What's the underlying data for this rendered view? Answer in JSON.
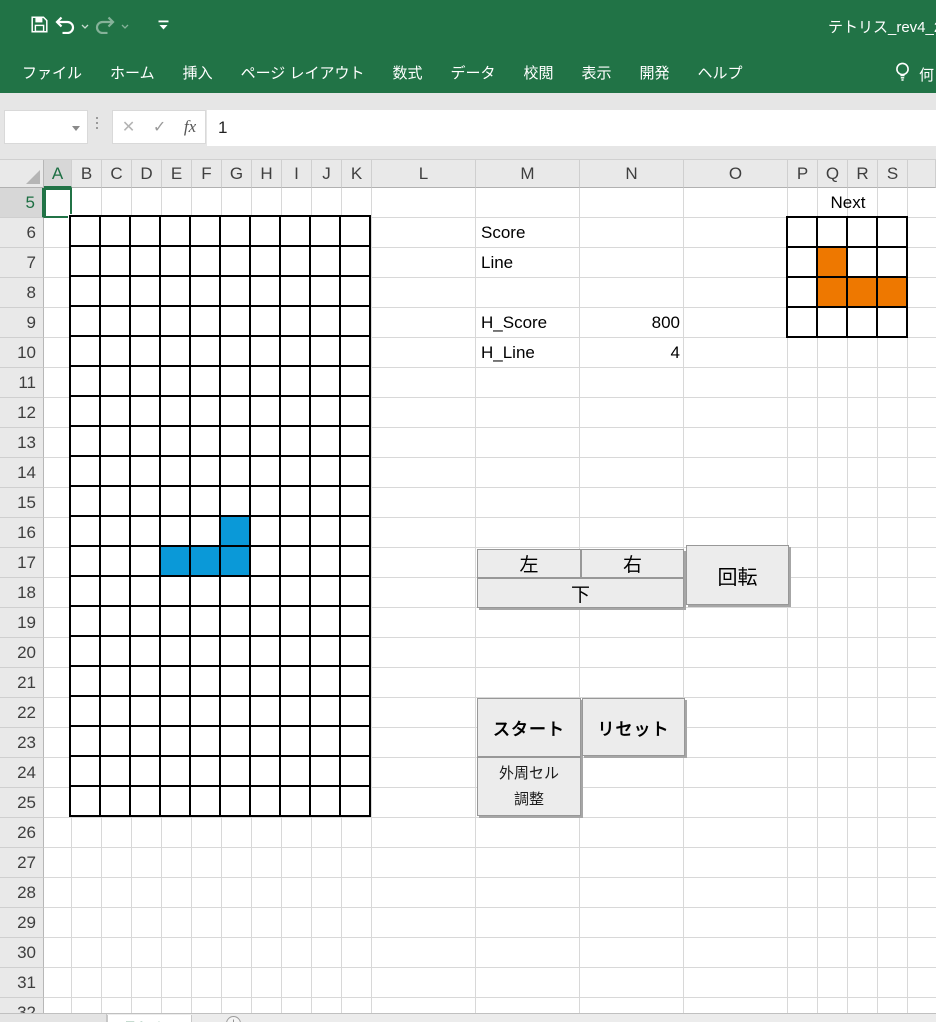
{
  "titlebar": {
    "title": "テトリス_rev4_2"
  },
  "ribbon": {
    "tabs": [
      "ファイル",
      "ホーム",
      "挿入",
      "ページ レイアウト",
      "数式",
      "データ",
      "校閲",
      "表示",
      "開発",
      "ヘルプ"
    ],
    "assist_partial_text": "何"
  },
  "formula_bar": {
    "name_box_value": "",
    "cancel_glyph": "✕",
    "check_glyph": "✓",
    "fx_glyph": "fx",
    "formula_value": "1"
  },
  "sheet": {
    "columns": [
      "A",
      "B",
      "C",
      "D",
      "E",
      "F",
      "G",
      "H",
      "I",
      "J",
      "K",
      "L",
      "M",
      "N",
      "O",
      "P",
      "Q",
      "R",
      "S",
      ""
    ],
    "rows": [
      "5",
      "6",
      "7",
      "8",
      "9",
      "10",
      "11",
      "12",
      "13",
      "14",
      "15",
      "16",
      "17",
      "18",
      "19",
      "20",
      "21",
      "22",
      "23",
      "24",
      "25",
      "26",
      "27",
      "28",
      "29",
      "30",
      "31",
      "32"
    ],
    "selected_column": "A",
    "selected_row": "5",
    "selected_cell": "A5"
  },
  "game": {
    "board": {
      "rows": 20,
      "cols": 10,
      "filled": [
        [
          11,
          6
        ],
        [
          12,
          4
        ],
        [
          12,
          5
        ],
        [
          12,
          6
        ]
      ],
      "fill_color": "#0a99d8"
    },
    "next": {
      "label": "Next",
      "rows": 4,
      "cols": 4,
      "filled": [
        [
          2,
          2
        ],
        [
          3,
          2
        ],
        [
          3,
          3
        ],
        [
          3,
          4
        ]
      ],
      "fill_color": "#ee7800"
    },
    "stats": {
      "score_label": "Score",
      "line_label": "Line",
      "high_score_label": "H_Score",
      "high_score_value": "800",
      "high_line_label": "H_Line",
      "high_line_value": "4"
    }
  },
  "buttons": {
    "left": "左",
    "right": "右",
    "down": "下",
    "rotate": "回転",
    "start": "スタート",
    "reset": "リセット",
    "adjust_line1": "外周セル",
    "adjust_line2": "調整"
  },
  "sheet_tabs": {
    "active": "テトリス",
    "add_glyph": "+"
  },
  "icons": {
    "quick_access": [
      "save-icon",
      "undo-icon",
      "chevron-down-icon",
      "redo-icon",
      "chevron-down-icon",
      "customize-qat-icon"
    ],
    "ribbon_right": [
      "lightbulb-icon"
    ],
    "formula_bar": [
      "name-box-dropdown-icon",
      "cancel-icon",
      "check-icon",
      "fx-icon"
    ],
    "sheet_corner": [
      "select-all-icon"
    ],
    "sheet_bar": [
      "add-sheet-icon"
    ]
  },
  "colors": {
    "ribbon_green": "#217346",
    "piece_blue": "#0a99d8",
    "piece_orange": "#ee7800",
    "grid_line": "#d8d8d8",
    "board_line": "#000000",
    "chrome_gray": "#e6e6e6",
    "button_gray": "#ececec"
  }
}
